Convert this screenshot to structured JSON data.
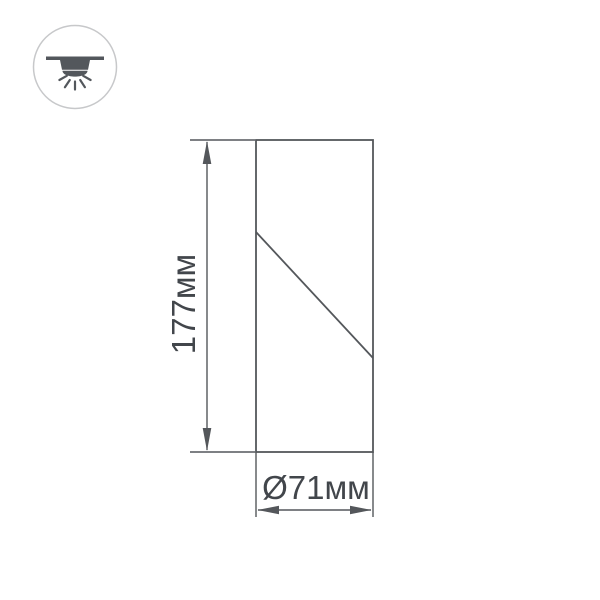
{
  "page": {
    "background": "#ffffff"
  },
  "badge": {
    "icon": "surface-mounted-downlight-icon",
    "ring_color": "#c7c8ca",
    "glyph_color": "#53575c"
  },
  "drawing": {
    "line_color": "#54575b",
    "text_color": "#42464b",
    "height": {
      "label": "177мм",
      "value_mm": 177
    },
    "diameter": {
      "label": "Ø71мм",
      "value_mm": 71
    }
  }
}
